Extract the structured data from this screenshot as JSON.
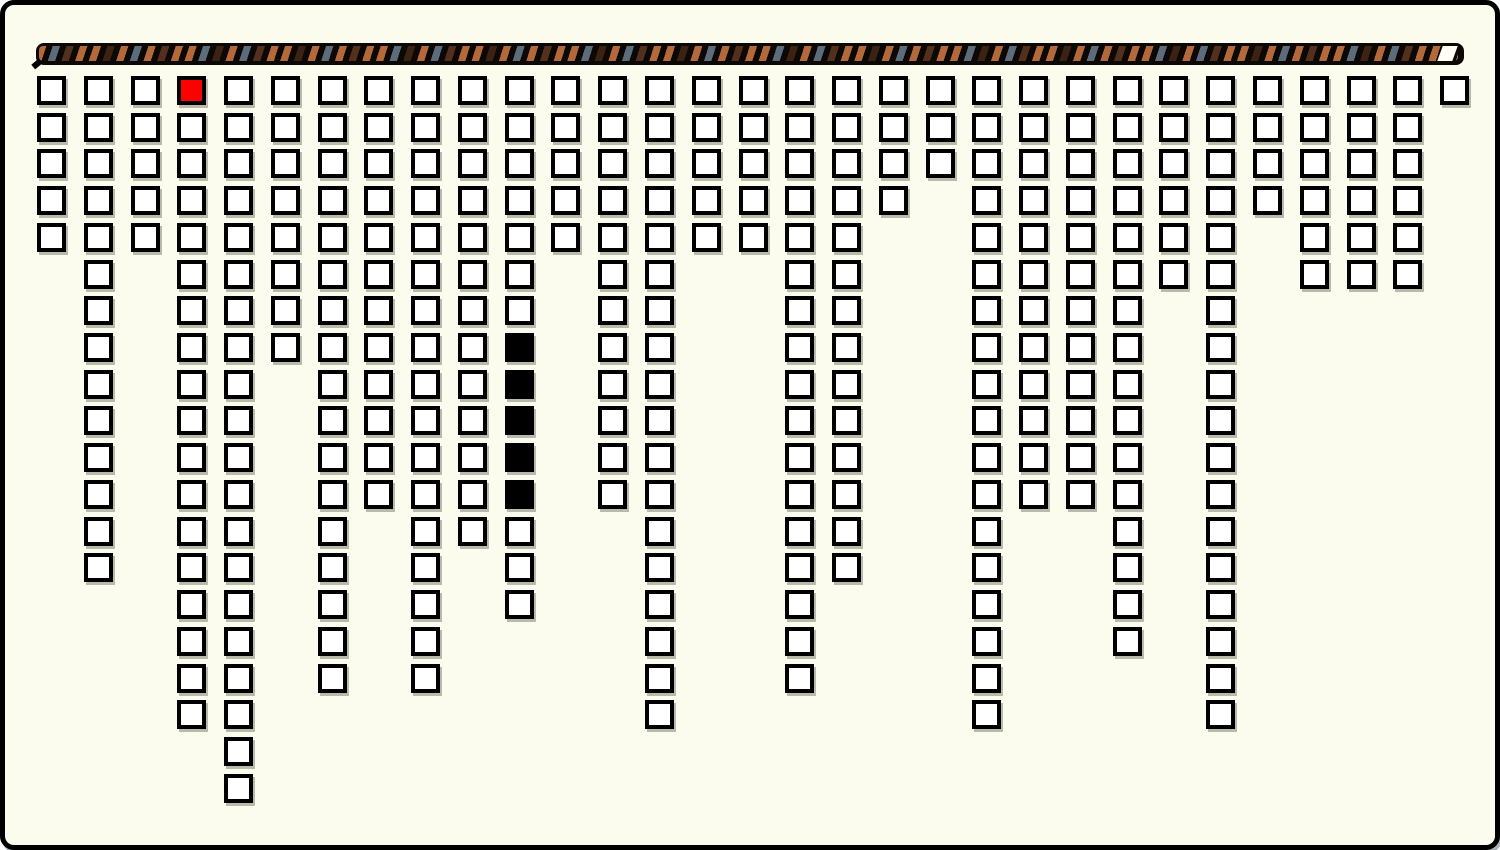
{
  "window": {
    "background_color": "#fcfcee",
    "frame_border_color": "#000000"
  },
  "rope_bar": {
    "base_color": "#0b0805",
    "stripe_colors": {
      "copper": "#b4693a",
      "slate": "#5d6c7b",
      "brown": "#53301d",
      "dark_brown": "#3c2213"
    },
    "stripe_sequence": [
      "copper",
      "slate",
      "brown",
      "copper",
      "copper",
      "dark_brown",
      "copper",
      "slate",
      "copper",
      "brown",
      "copper",
      "copper",
      "slate",
      "dark_brown"
    ],
    "end_cap_color": "#fffff6"
  },
  "board": {
    "columns": 31,
    "rows_max": 20,
    "cell_colors": {
      "normal_fill": "#ffffff",
      "red_fill": "#fb0200",
      "black_fill": "#000000",
      "border": "#000000"
    },
    "red_cell": {
      "col": 4,
      "row": 1
    },
    "black_cells": {
      "col": 11,
      "rows": [
        8,
        9,
        10,
        11,
        12
      ]
    },
    "stacks": [
      {
        "col": 1,
        "height": 5
      },
      {
        "col": 2,
        "height": 14
      },
      {
        "col": 3,
        "height": 5
      },
      {
        "col": 4,
        "height": 18,
        "red_rows": [
          1
        ]
      },
      {
        "col": 5,
        "height": 20
      },
      {
        "col": 6,
        "height": 8
      },
      {
        "col": 7,
        "height": 17
      },
      {
        "col": 8,
        "height": 12
      },
      {
        "col": 9,
        "height": 17
      },
      {
        "col": 10,
        "height": 13
      },
      {
        "col": 11,
        "height": 15,
        "black_rows": [
          8,
          9,
          10,
          11,
          12
        ]
      },
      {
        "col": 12,
        "height": 5
      },
      {
        "col": 13,
        "height": 12
      },
      {
        "col": 14,
        "height": 18
      },
      {
        "col": 15,
        "height": 5
      },
      {
        "col": 16,
        "height": 5
      },
      {
        "col": 17,
        "height": 17
      },
      {
        "col": 18,
        "height": 14
      },
      {
        "col": 19,
        "height": 4
      },
      {
        "col": 20,
        "height": 3
      },
      {
        "col": 21,
        "height": 18
      },
      {
        "col": 22,
        "height": 12
      },
      {
        "col": 23,
        "height": 12
      },
      {
        "col": 24,
        "height": 16
      },
      {
        "col": 25,
        "height": 6
      },
      {
        "col": 26,
        "height": 18
      },
      {
        "col": 27,
        "height": 4
      },
      {
        "col": 28,
        "height": 6
      },
      {
        "col": 29,
        "height": 6
      },
      {
        "col": 30,
        "height": 6
      },
      {
        "col": 31,
        "height": 1
      }
    ]
  }
}
